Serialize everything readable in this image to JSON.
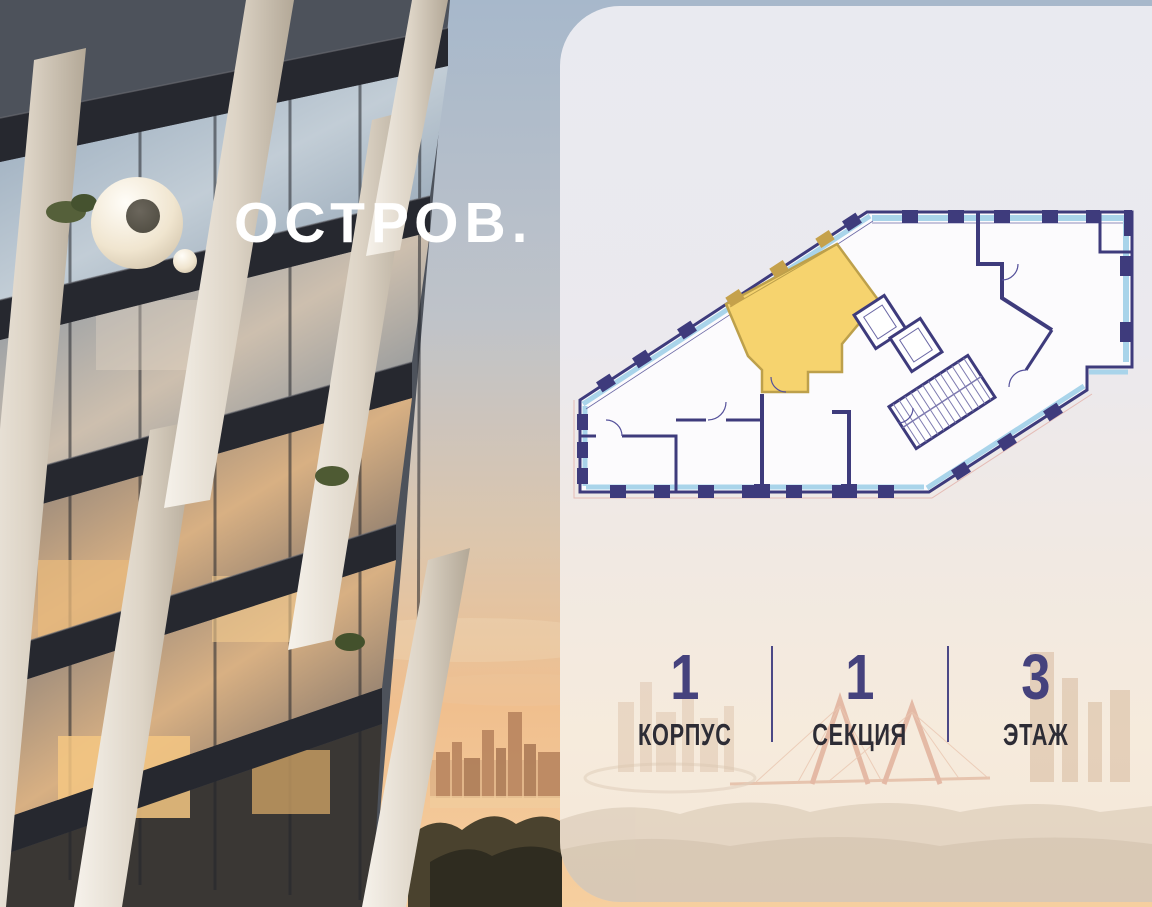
{
  "brand": {
    "logo_text": "ОСТРОВ.",
    "logo_mark": "o-ring-with-dot"
  },
  "panel": {
    "stats": [
      {
        "value": "1",
        "label": "КОРПУС"
      },
      {
        "value": "1",
        "label": "СЕКЦИЯ"
      },
      {
        "value": "3",
        "label": "ЭТАЖ"
      }
    ],
    "floorplan": {
      "type": "floor-plan-drawing",
      "highlighted_unit": {
        "name": "selected-apartment",
        "fill": "#f6d36e",
        "stroke": "#bda04b"
      },
      "wall_color": "#3e3b7c",
      "window_color": "#a9d4ea"
    }
  },
  "colors": {
    "stat_number": "#45427d",
    "stat_label": "#2d2c35",
    "divider": "#4b4886",
    "panel_bg_top": "#e9eaf0",
    "panel_bg_bottom": "#f3e6d8",
    "logo_color": "#ffffff"
  }
}
